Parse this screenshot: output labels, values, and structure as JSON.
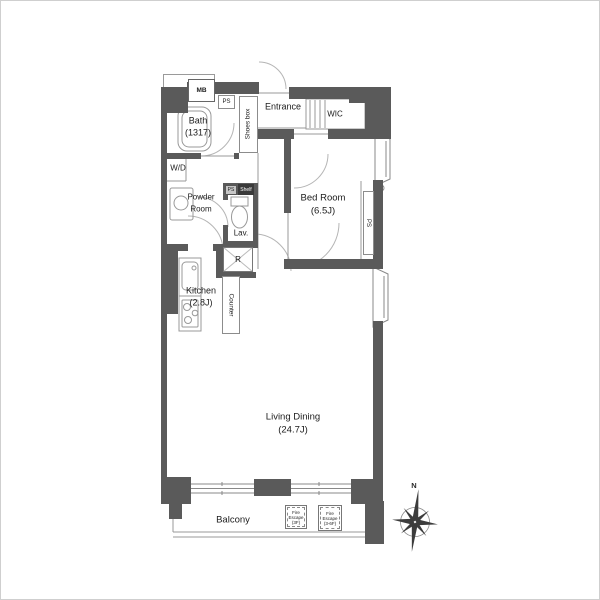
{
  "rooms": {
    "bath": {
      "name": "Bath",
      "size": "(1317)"
    },
    "wd": {
      "name": "W/D"
    },
    "powder_room": {
      "line1": "Powder",
      "line2": "Room"
    },
    "lav": {
      "name": "Lav."
    },
    "entrance": {
      "name": "Entrance"
    },
    "wic": {
      "name": "WIC"
    },
    "bed_room": {
      "name": "Bed Room",
      "size": "(6.5J)"
    },
    "kitchen": {
      "name": "Kitchen",
      "size": "(2.8J)"
    },
    "living_dining": {
      "name": "Living Dining",
      "size": "(24.7J)"
    },
    "balcony": {
      "name": "Balcony"
    }
  },
  "fixtures": {
    "meter_box": "MB",
    "pipe_space_top": "PS",
    "pipe_space_mid": "PS",
    "pipe_space_right": "PS",
    "shoes_box": "Shoes box",
    "shelf": "Shelf",
    "refrigerator": "R",
    "counter": "Counter"
  },
  "fire_escapes": [
    {
      "line1": "Fire",
      "line2": "Escape",
      "line3": "(3F)"
    },
    {
      "line1": "Fire",
      "line2": "Escape",
      "line3": "(3-6F)"
    }
  ],
  "compass": {
    "north": "N"
  },
  "colors": {
    "wall": "#5a5a5a",
    "thin_line": "#999999",
    "door_arc": "#b8b8b8",
    "text": "#1c1c1c"
  }
}
